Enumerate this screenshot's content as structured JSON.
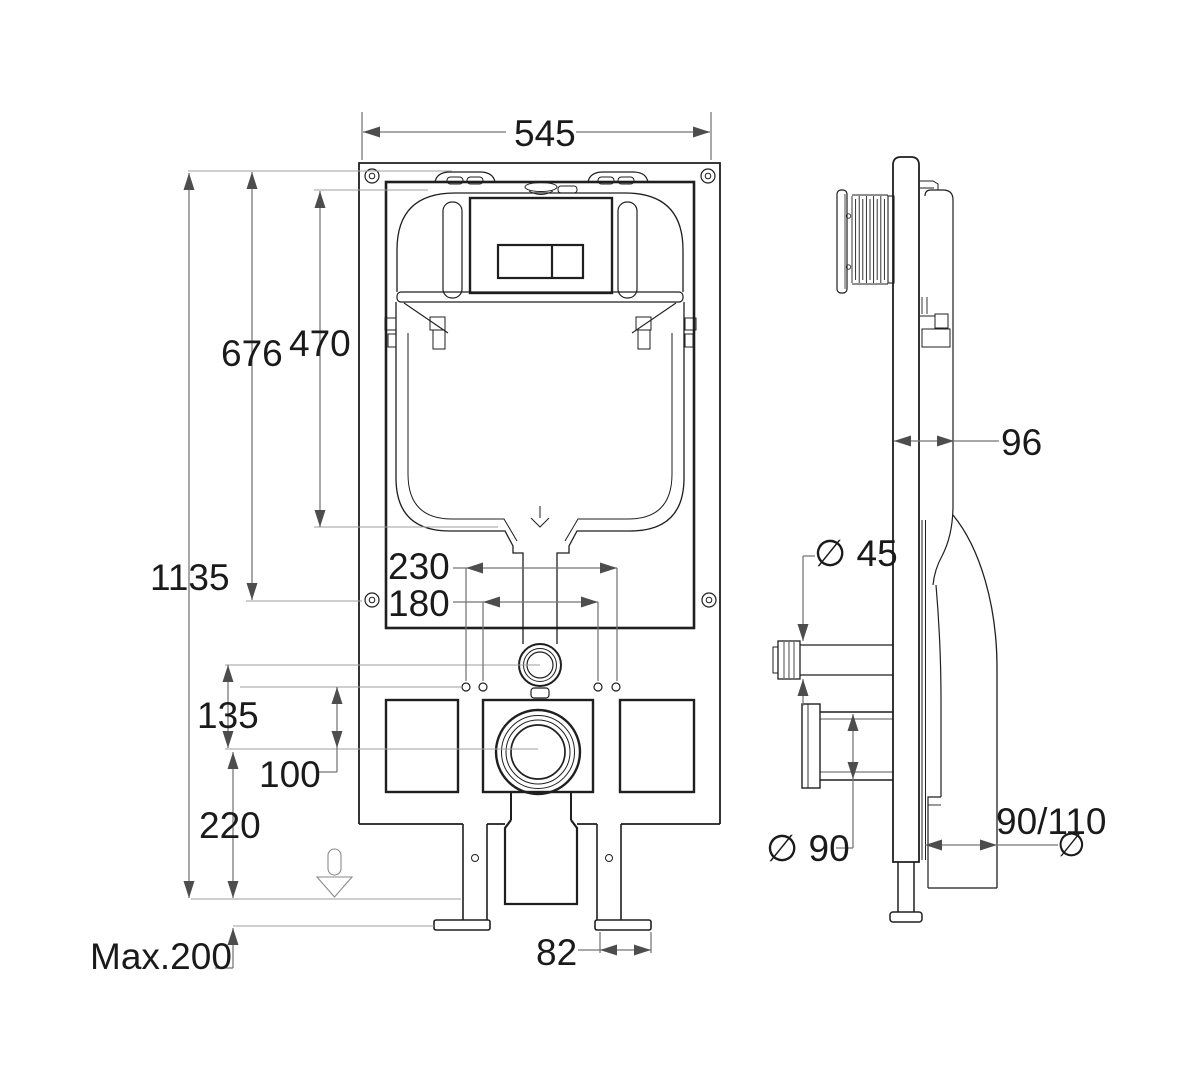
{
  "drawing": {
    "type": "technical installation drawing",
    "subject": "concealed cistern wall-mount frame, front and side views",
    "colors": {
      "background": "#ffffff",
      "object_line": "#1f1f1f",
      "dimension_line": "#757575",
      "leader_line": "#9d9d9d",
      "label_text": "#1a1a1a"
    },
    "dimensions": {
      "overall_width": "545",
      "overall_height": "1135",
      "upper_fixing_height": "676",
      "cistern_height": "470",
      "fixing_spacing_outer": "230",
      "fixing_spacing_inner": "180",
      "inlet_to_outlet_drop": "135",
      "fixing_to_outlet_drop": "100",
      "outlet_center_height": "220",
      "max_floor_adjustment": "Max.200",
      "foot_plate_width": "82",
      "frame_depth": "96",
      "flush_pipe_diameter": "∅ 45",
      "outlet_pipe_diameter": "∅ 90",
      "bend_pipe_size": "90/110",
      "bend_diameter_symbol": "∅"
    }
  }
}
